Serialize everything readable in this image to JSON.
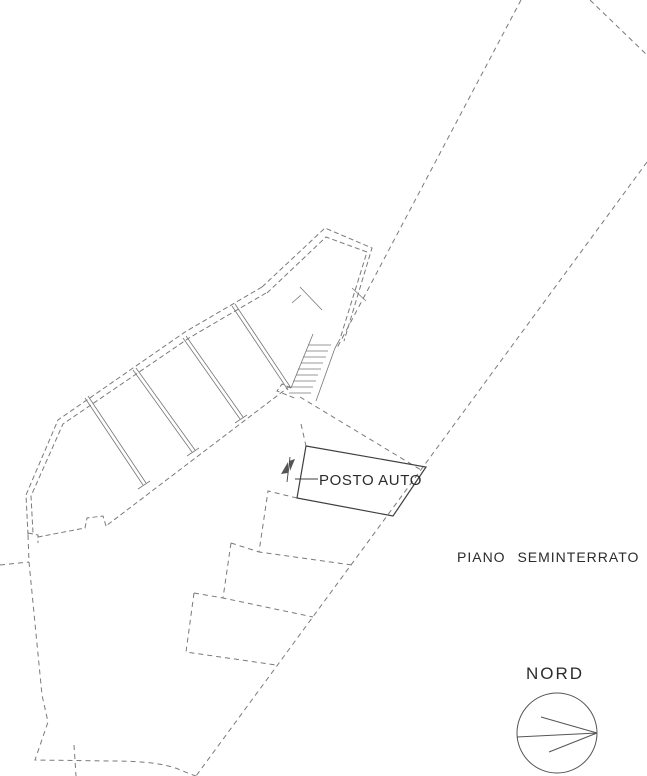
{
  "drawing": {
    "title": "PIANO SEMINTERRATO",
    "labels": {
      "parking_space": "POSTO AUTO",
      "floor": "PIANO SEMINTERRATO",
      "north": "NORD"
    },
    "colors": {
      "background": "#ffffff",
      "dashed_line": "#7a7a7a",
      "solid_line": "#3f3f3f",
      "thin_line": "#777777",
      "compass_line": "#555555",
      "text": "#2b2b2b"
    }
  }
}
